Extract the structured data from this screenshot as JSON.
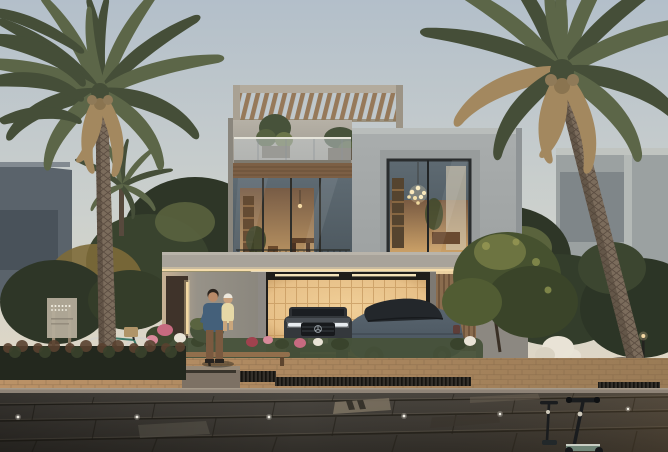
{
  "meta": {
    "description": "Dusk photorealistic rendering of a modern two-storey villa: rooftop pergola terrace, glass balcony with plants, offset grey cube volume with a large square window and chandelier, warm backlit carport holding a dark SUV and a blue-grey sedan, entrance wall with a father holding a child, flowering landscaping, a small community sign, a parked bicycle, two date palms framing the scene, neighbouring villas behind trees, a warm brick sidewalk with drainage grates and a dark paved street with in-ground lights and two kick scooters.",
    "time_of_day": "dusk",
    "width_px": 668,
    "height_px": 452
  },
  "palette": {
    "sky_top": "#b3bfca",
    "sky_mid": "#cdd1cd",
    "sky_horizon": "#e3d8c4",
    "villa_wall": "#b6b1a6",
    "villa_wall_shade": "#9b968d",
    "entrance_wall": "#979288",
    "entrance_light": "#c8b294",
    "cube_wall": "#a9adad",
    "cube_wall_shade": "#8f9496",
    "pergola_wood": "#96795a",
    "wood_band": "#7c5f45",
    "wood_gate": "#8a6c4e",
    "glass_cool": "#5e6a72",
    "glass_reflect": "#c6ced2",
    "interior_glow": "#d8a868",
    "interior_deep": "#7d5a3e",
    "garage_glow": "#e7c088",
    "garage_line": "#c09257",
    "soffit_light": "#f6ddab",
    "foliage_dark": "#2e3627",
    "foliage_mid": "#47523a",
    "foliage_light": "#6e7549",
    "foliage_warm": "#7d6a38",
    "frond_green": "#5c6648",
    "frond_deep": "#454e38",
    "frond_dry": "#a3885f",
    "trunk_light": "#7b6c5c",
    "trunk_dark": "#57493d",
    "neighbor_left": "#5a636b",
    "neighbor_right": "#9ba1a1",
    "suv_body": "#34383c",
    "sedan_body": "#47525c",
    "sedan_top": "#23272b",
    "headlight": "#e8edf0",
    "skin": "#b98a68",
    "shirt": "#44607a",
    "pants": "#7a5a40",
    "child_dress": "#e6d8a6",
    "road": "#4b4741",
    "road_dark": "#312e29",
    "road_light": "#79705f",
    "road_joint": "#232019",
    "sidewalk": "#bb9267",
    "sidewalk_dark": "#9a7b56",
    "curb": "#8e8377",
    "grate": "#34302a",
    "flower_pink": "#c76a80",
    "flower_white": "#e9e3d6",
    "flower_red": "#a0424e",
    "metal": "#1a1c1e",
    "light_warm": "#f4d9a4",
    "glow_white": "#f3f0e6",
    "bench_wood": "#916f4c",
    "stone": "#7d7164",
    "teal_bike": "#3f7a6a",
    "scooter_deck": "#6f8577"
  },
  "scene": {
    "background": {
      "sky": "clear dusk sky, pale blue fading to warm sand at the horizon",
      "left_neighbor": "dark slate neighbouring villa behind dense shrubs",
      "right_neighbor": "light grey neighbouring villa behind trees",
      "trees": "dark green tree masses with warm autumn highlights"
    },
    "villa": {
      "pergola": "timber slat pergola on the roof terrace",
      "balcony": "glass balustrade balcony with potted plants",
      "wood_band": "horizontal timber cladding band",
      "living_window": "double-height glazing with warm lit interior and dining furniture",
      "cube": "offset grey cube volume with recessed square window",
      "chandelier": "cluster bulb chandelier behind the cube window",
      "carport": "flat slab carport with warm LED soffit strip and backlit panel wall",
      "entrance": "entrance wall with dark timber door and warm light slit",
      "gate": "vertical timber slat side gate"
    },
    "vehicles": [
      {
        "type": "suv",
        "description": "dark grey SUV parked nose-out inside the backlit carport"
      },
      {
        "type": "sedan",
        "description": "blue-grey luxury sedan with dark roof parked on the driveway, seen from the rear three-quarter"
      }
    ],
    "people": [
      {
        "role": "father",
        "description": "man in blue t-shirt and brown trousers holding a child"
      },
      {
        "role": "child",
        "description": "toddler in pale yellow outfit and white hat"
      }
    ],
    "props": [
      "community sign with illegible dotted lettering and uplights",
      "city bicycle with front basket leaning by the hedge",
      "timber bench and stone planter with a small tree",
      "boulder and bollard light on the right verge",
      "two kick scooters on the street, bottom right"
    ],
    "street": {
      "sidewalk": "warm brick paver band with long drainage grates",
      "road": "large dark stone pavers with recessed marker lights",
      "lighting": "small round in-ground lights along the lane"
    }
  }
}
